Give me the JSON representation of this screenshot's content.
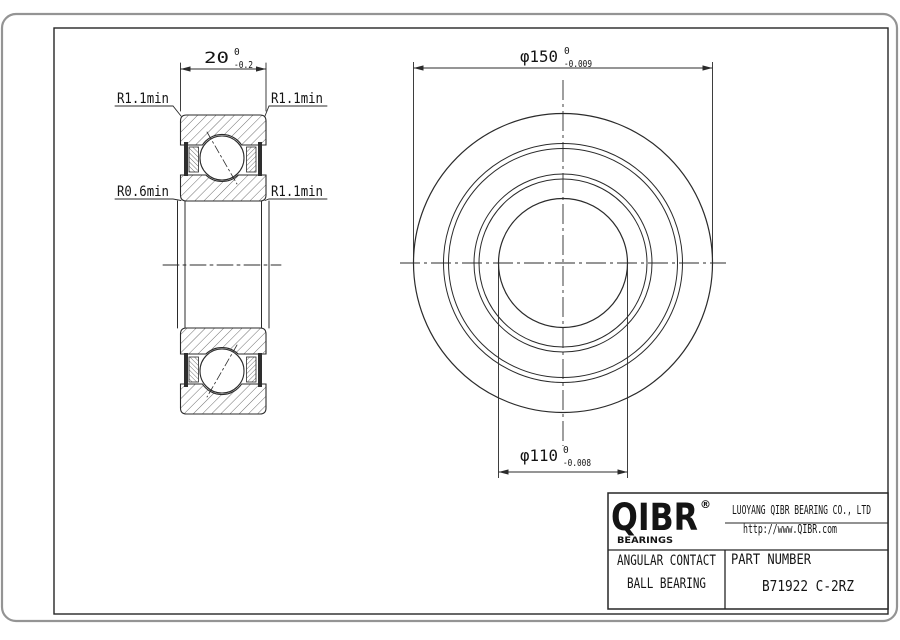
{
  "page": {
    "background": "#ffffff",
    "card_border_color": "#949494",
    "line_color": "#2b2b2b"
  },
  "dimensions": {
    "width": {
      "value": "20",
      "tol_upper": "0",
      "tol_lower": "-0.2"
    },
    "outer_diameter": {
      "value": "φ150",
      "tol_upper": "0",
      "tol_lower": "-0.009"
    },
    "bore_diameter": {
      "value": "φ110",
      "tol_upper": "0",
      "tol_lower": "-0.008"
    }
  },
  "radius_labels": {
    "top_left": "R1.1min",
    "top_right": "R1.1min",
    "mid_left": "R0.6min",
    "mid_right": "R1.1min"
  },
  "title_block": {
    "logo_text": "QIBR",
    "logo_registered": "®",
    "logo_subtext": "BEARINGS",
    "company": "LUOYANG QIBR BEARING CO., LTD",
    "website": "http://www.QIBR.com",
    "product_line1": "ANGULAR CONTACT",
    "product_line2": "BALL BEARING",
    "part_number_label": "PART NUMBER",
    "part_number": "B71922 C-2RZ"
  }
}
